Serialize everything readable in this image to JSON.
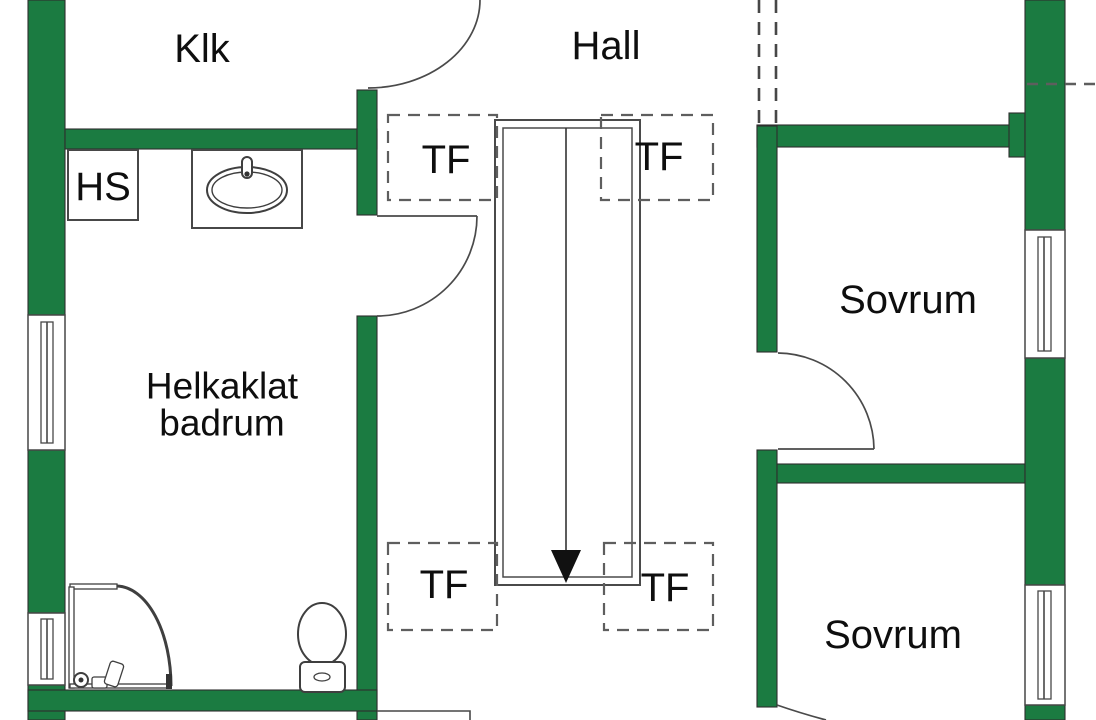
{
  "floorplan": {
    "rooms": {
      "closet": "Klk",
      "hall": "Hall",
      "hs_cabinet": "HS",
      "bathroom_lines": [
        "Helkaklat",
        "badrum"
      ],
      "bedroom_top": "Sovrum",
      "bedroom_bottom": "Sovrum"
    },
    "markers": {
      "roof_window": "TF"
    },
    "colors": {
      "wall": "#1b7b41",
      "line": "#474747",
      "dash": "#5e5e5e",
      "fixture": "#3f3f3f",
      "text": "#0e0e0e"
    },
    "symbols": {
      "stairs": "stairs-down-arrow",
      "doors": "door-swing-arc",
      "windows": "window-double-line",
      "sink": "oval-basin-sink",
      "toilet": "toilet",
      "shower": "corner-shower"
    }
  }
}
